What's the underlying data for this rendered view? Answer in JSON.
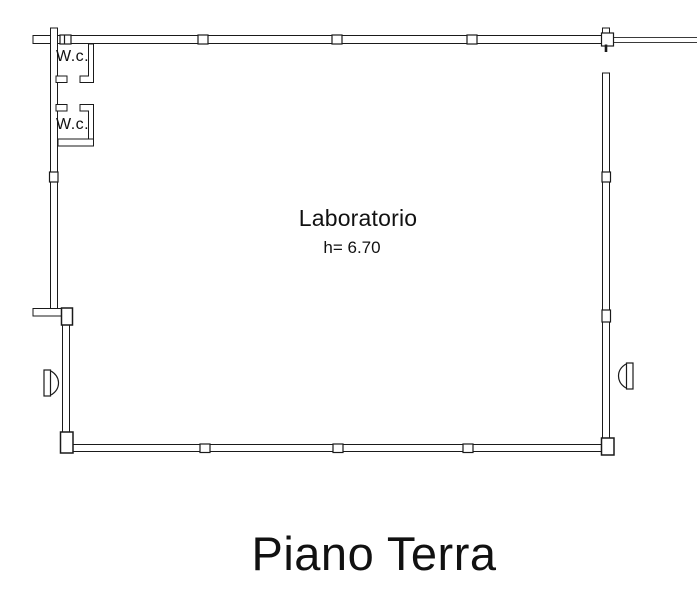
{
  "floor_plan": {
    "title": "Piano Terra",
    "main_room": {
      "name": "Laboratorio",
      "ceiling_height": "h= 6.70"
    },
    "wc_rooms": [
      {
        "label": "W.c."
      },
      {
        "label": "W.c."
      }
    ],
    "symbols": [
      "window-symbol-left",
      "window-symbol-right",
      "column-markers",
      "door-opening-top-right",
      "wc-door-openings"
    ],
    "colors": {
      "wall_line": "#1a1a1a",
      "thin_line": "#3a3a3a",
      "background": "#ffffff",
      "text": "#111111"
    }
  }
}
